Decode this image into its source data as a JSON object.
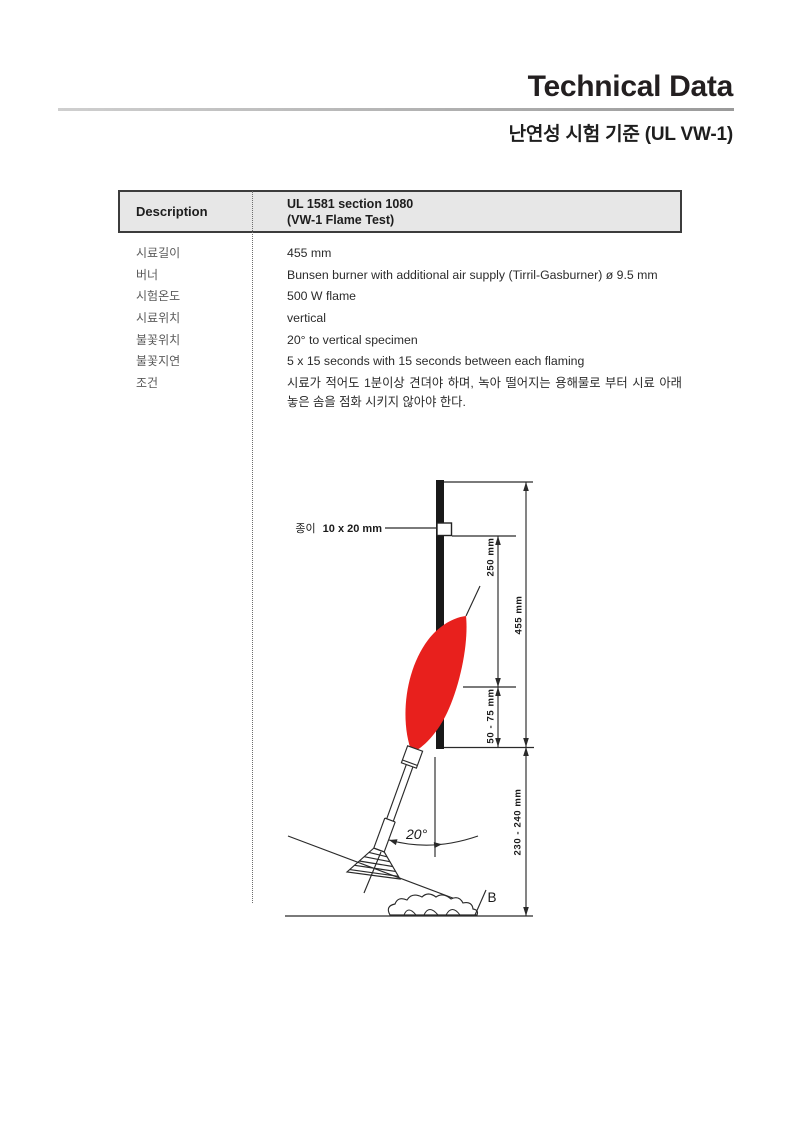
{
  "page": {
    "title": "Technical Data",
    "subtitle": "난연성 시험 기준 (UL VW-1)"
  },
  "table": {
    "header": {
      "label": "Description",
      "value_line1": "UL 1581 section 1080",
      "value_line2": "(VW-1 Flame Test)"
    },
    "rows": [
      {
        "label": "시료길이",
        "value": "455 mm"
      },
      {
        "label": "버너",
        "value": "Bunsen burner with additional air supply (Tirril-Gasburner) ø 9.5 mm"
      },
      {
        "label": "시험온도",
        "value": "500 W flame"
      },
      {
        "label": "시료위치",
        "value": "vertical"
      },
      {
        "label": "불꽃위치",
        "value": "20° to vertical specimen"
      },
      {
        "label": "불꽃지연",
        "value": "5 x 15 seconds with 15 seconds between each flaming"
      },
      {
        "label": "조건",
        "value": "시료가 적어도 1분이상 견뎌야 하며, 녹아 떨어지는 용해물로 부터 시료 아래 놓은 솜을 점화 시키지 않아야 한다."
      }
    ]
  },
  "diagram": {
    "paper_label_prefix": "종이",
    "paper_label_size": "10 x 20 mm",
    "dims": {
      "d250": "250 mm",
      "d455": "455 mm",
      "d50_75": "50 - 75 mm",
      "d230_240": "230 - 240 mm"
    },
    "angle": "20°",
    "cotton_label": "B",
    "flame_color": "#e8201d"
  }
}
